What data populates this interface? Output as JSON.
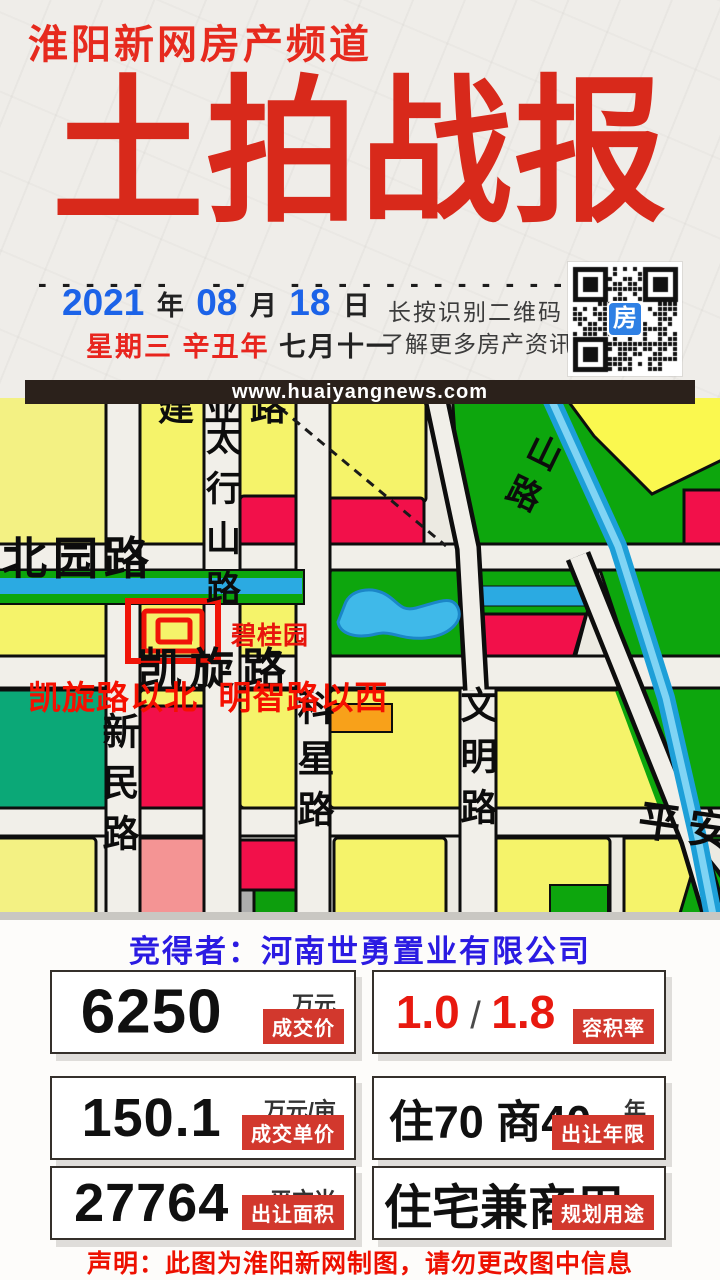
{
  "header": {
    "channel": "淮阳新网房产频道"
  },
  "title": {
    "text": "土拍战报"
  },
  "divider": {
    "d1": "- - - - - -",
    "d2": "- -",
    "d3": "- - - - - - - - - - - - - - - -"
  },
  "date": {
    "year": "2021",
    "year_cn": "年",
    "month": "08",
    "month_cn": "月",
    "day": "18",
    "day_cn": "日",
    "weekday": "星期三",
    "lunar_year": "辛丑年",
    "lunar_date": "七月十一"
  },
  "qr": {
    "hint_line1": "长按识别二维码",
    "hint_line2": "了解更多房产资讯",
    "center_label": "房"
  },
  "url_bar": {
    "url": "www.huaiyangnews.com"
  },
  "map": {
    "labels": {
      "jianye": "建业路",
      "taihang": "太行山路",
      "beiyuan": "北园路",
      "shan_road": "山路",
      "kaixuan": "凯旋路",
      "biguiyuan": "碧桂园",
      "caption": "凯旋路以北  明智路以西",
      "xinmin": "新民路",
      "kexing": "科星路",
      "wenming": "文明路",
      "pingan": "平安"
    }
  },
  "winner": {
    "text": "竞得者：河南世勇置业有限公司"
  },
  "cards": [
    {
      "value": "6250",
      "unit": "万元",
      "badge": "成交价"
    },
    {
      "value_a": "1.0",
      "sep": "/",
      "value_b": "1.8",
      "badge": "容积率"
    },
    {
      "value": "150.1",
      "unit": "万元/亩",
      "badge": "成交单价"
    },
    {
      "value": "住70 商40",
      "unit": "年",
      "badge": "出让年限"
    },
    {
      "value": "27764",
      "unit": "平方米",
      "badge": "出让面积"
    },
    {
      "value": "住宅兼商用",
      "badge": "规划用途"
    }
  ],
  "footer": {
    "disclaimer": "声明：此图为淮阳新网制图，请勿更改图中信息"
  },
  "colors": {
    "accent_red": "#e62a1e",
    "title_red": "#d8291b",
    "date_blue": "#1c63e8",
    "winner_blue": "#2b1be2",
    "badge_red": "#d2382d",
    "caption_red": "#f51000",
    "map_yellow": "#f5f36a",
    "map_pale_yellow": "#f3f183",
    "map_red": "#f2104a",
    "map_green": "#0da60d",
    "map_teal": "#0ba877",
    "map_canal_blue": "#2baae2",
    "map_pond_blue": "#3fb9e9",
    "map_orange": "#f8a11a",
    "map_pink": "#f49494",
    "map_gray": "#adadad",
    "urlbar_bg": "#2b211b"
  }
}
